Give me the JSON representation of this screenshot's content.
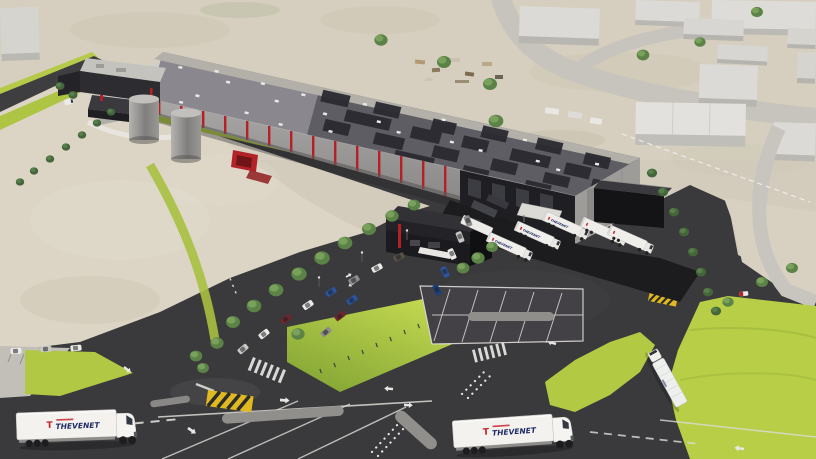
{
  "meta": {
    "type": "3d-architectural-rendering",
    "subject": "Aerial 3D rendering of a THEVENET logistics warehouse site with solar roof, loading docks, truck yard, car parking, landscaped roads and surrounding industrial estate"
  },
  "branding": {
    "truck_logo_mark": "T",
    "truck_logo_text": "THEVENET"
  },
  "palette": {
    "terrain": "#d3ccbd",
    "field": "#dcd5c5",
    "asphalt": "#3a393b",
    "grass": "#b4cb45",
    "roof_dark": "#5f5d64",
    "roof_light": "#8a888e",
    "solar_panel": "#2b2a31",
    "facade_gray": "#9b9997",
    "dark_cladding": "#1f1f23",
    "accent_red": "#b32025",
    "building_white": "#dcdad6",
    "marking_white": "#e8e7e3",
    "crosswalk_yellow": "#dfb91f",
    "truck_white": "#f2f1ee"
  },
  "vehicles": {
    "road_trucks": 3,
    "docked_trailers": 6,
    "parked_cars": 19
  }
}
